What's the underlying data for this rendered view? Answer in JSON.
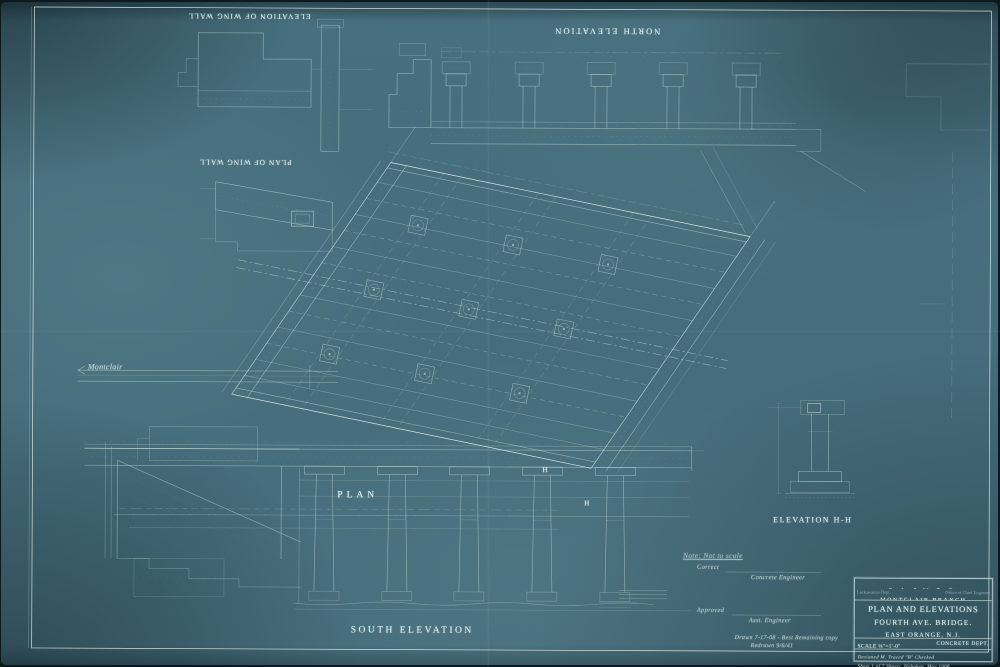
{
  "sheet": {
    "labels": {
      "north_elevation": "NORTH ELEVATION",
      "elevation_of_wing_wall": "ELEVATION OF WING WALL",
      "plan_of_wing_wall": "PLAN OF WING WALL",
      "plan": "PLAN",
      "south_elevation": "SOUTH ELEVATION",
      "elevation_hh": "ELEVATION H-H"
    },
    "annotations": {
      "montclair": "Montclair",
      "note": "Note: Not to scale",
      "correct": "Correct",
      "concrete_engineer": "Concrete Engineer",
      "approved": "Approved",
      "asst_engineer": "Asst. Engineer",
      "pencil_note_1": "Drawn 7-17-08 - Best Remaining copy",
      "pencil_note_2": "Redrawn 9/6/41",
      "section_marker": "H"
    },
    "title_block": {
      "railroad": "D. L. & W. R. R.",
      "branch": "MONTCLAIR BRANCH",
      "office_left": "Lackawanna Dept.",
      "office_right": "Office of Chief Engineer",
      "title_line_1": "PLAN AND ELEVATIONS",
      "title_line_2": "FOURTH AVE. BRIDGE.",
      "location": "EAST ORANGE, N.J.",
      "scale": "SCALE ⅛\"=1'-0\"",
      "department": "CONCRETE DEPT.",
      "credits": "Designed M.   Traced \"B\"   Checked",
      "sheet_info": "Sheet 1 of 7 Sheets, Hoboken, May 1908"
    },
    "colors": {
      "paper": "#476f7d",
      "line": "#bedbd9",
      "bright": "#ecf8f5"
    }
  }
}
